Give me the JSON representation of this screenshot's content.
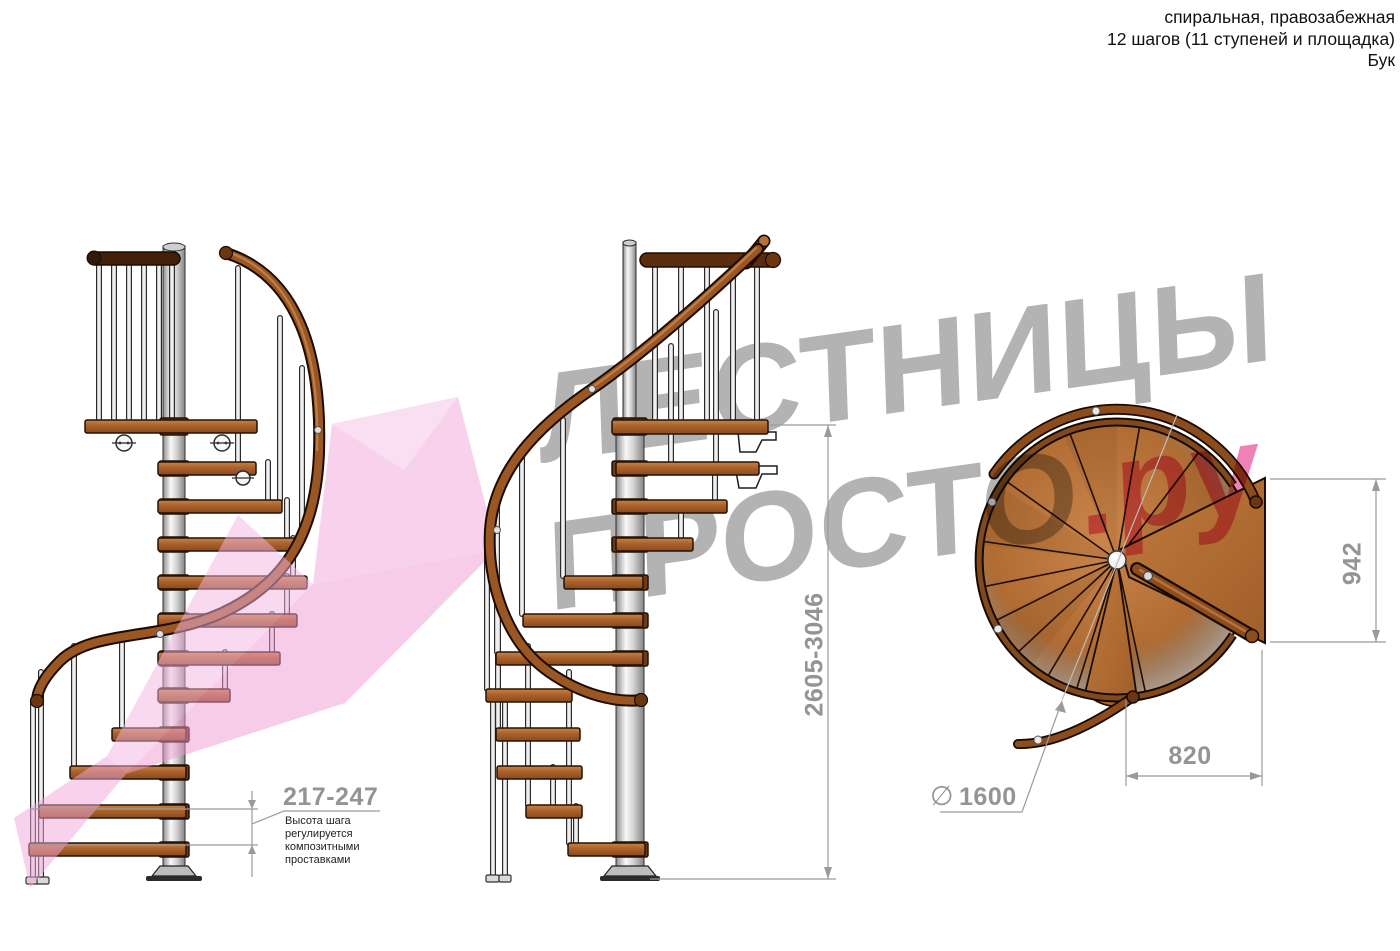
{
  "header": {
    "line1": "спиральная, правозабежная",
    "line2": "12 шагов (11 ступеней и площадка)",
    "line3": "Бук"
  },
  "watermark": {
    "word1": "ЛЕСТНИЦЫ",
    "word2": "ПРОСТО",
    "suffix": ".ру"
  },
  "annotations": {
    "step_height_value": "217-247",
    "step_height_note": "Высота шага\nрегулируется\nкомпозитными\nпроставками",
    "total_height_value": "2605-3046",
    "plan_depth_value": "942",
    "plan_width_value": "820",
    "diameter_symbol": "∅",
    "diameter_value": "1600"
  },
  "colors": {
    "watermark_gray": "#b3b3b3",
    "accent_pink": "#ee82b6",
    "wood_brown": "#a9612c",
    "handrail_brown": "#9a5723",
    "dimension_gray": "#979797",
    "column_metal": "#d9d9d9"
  }
}
